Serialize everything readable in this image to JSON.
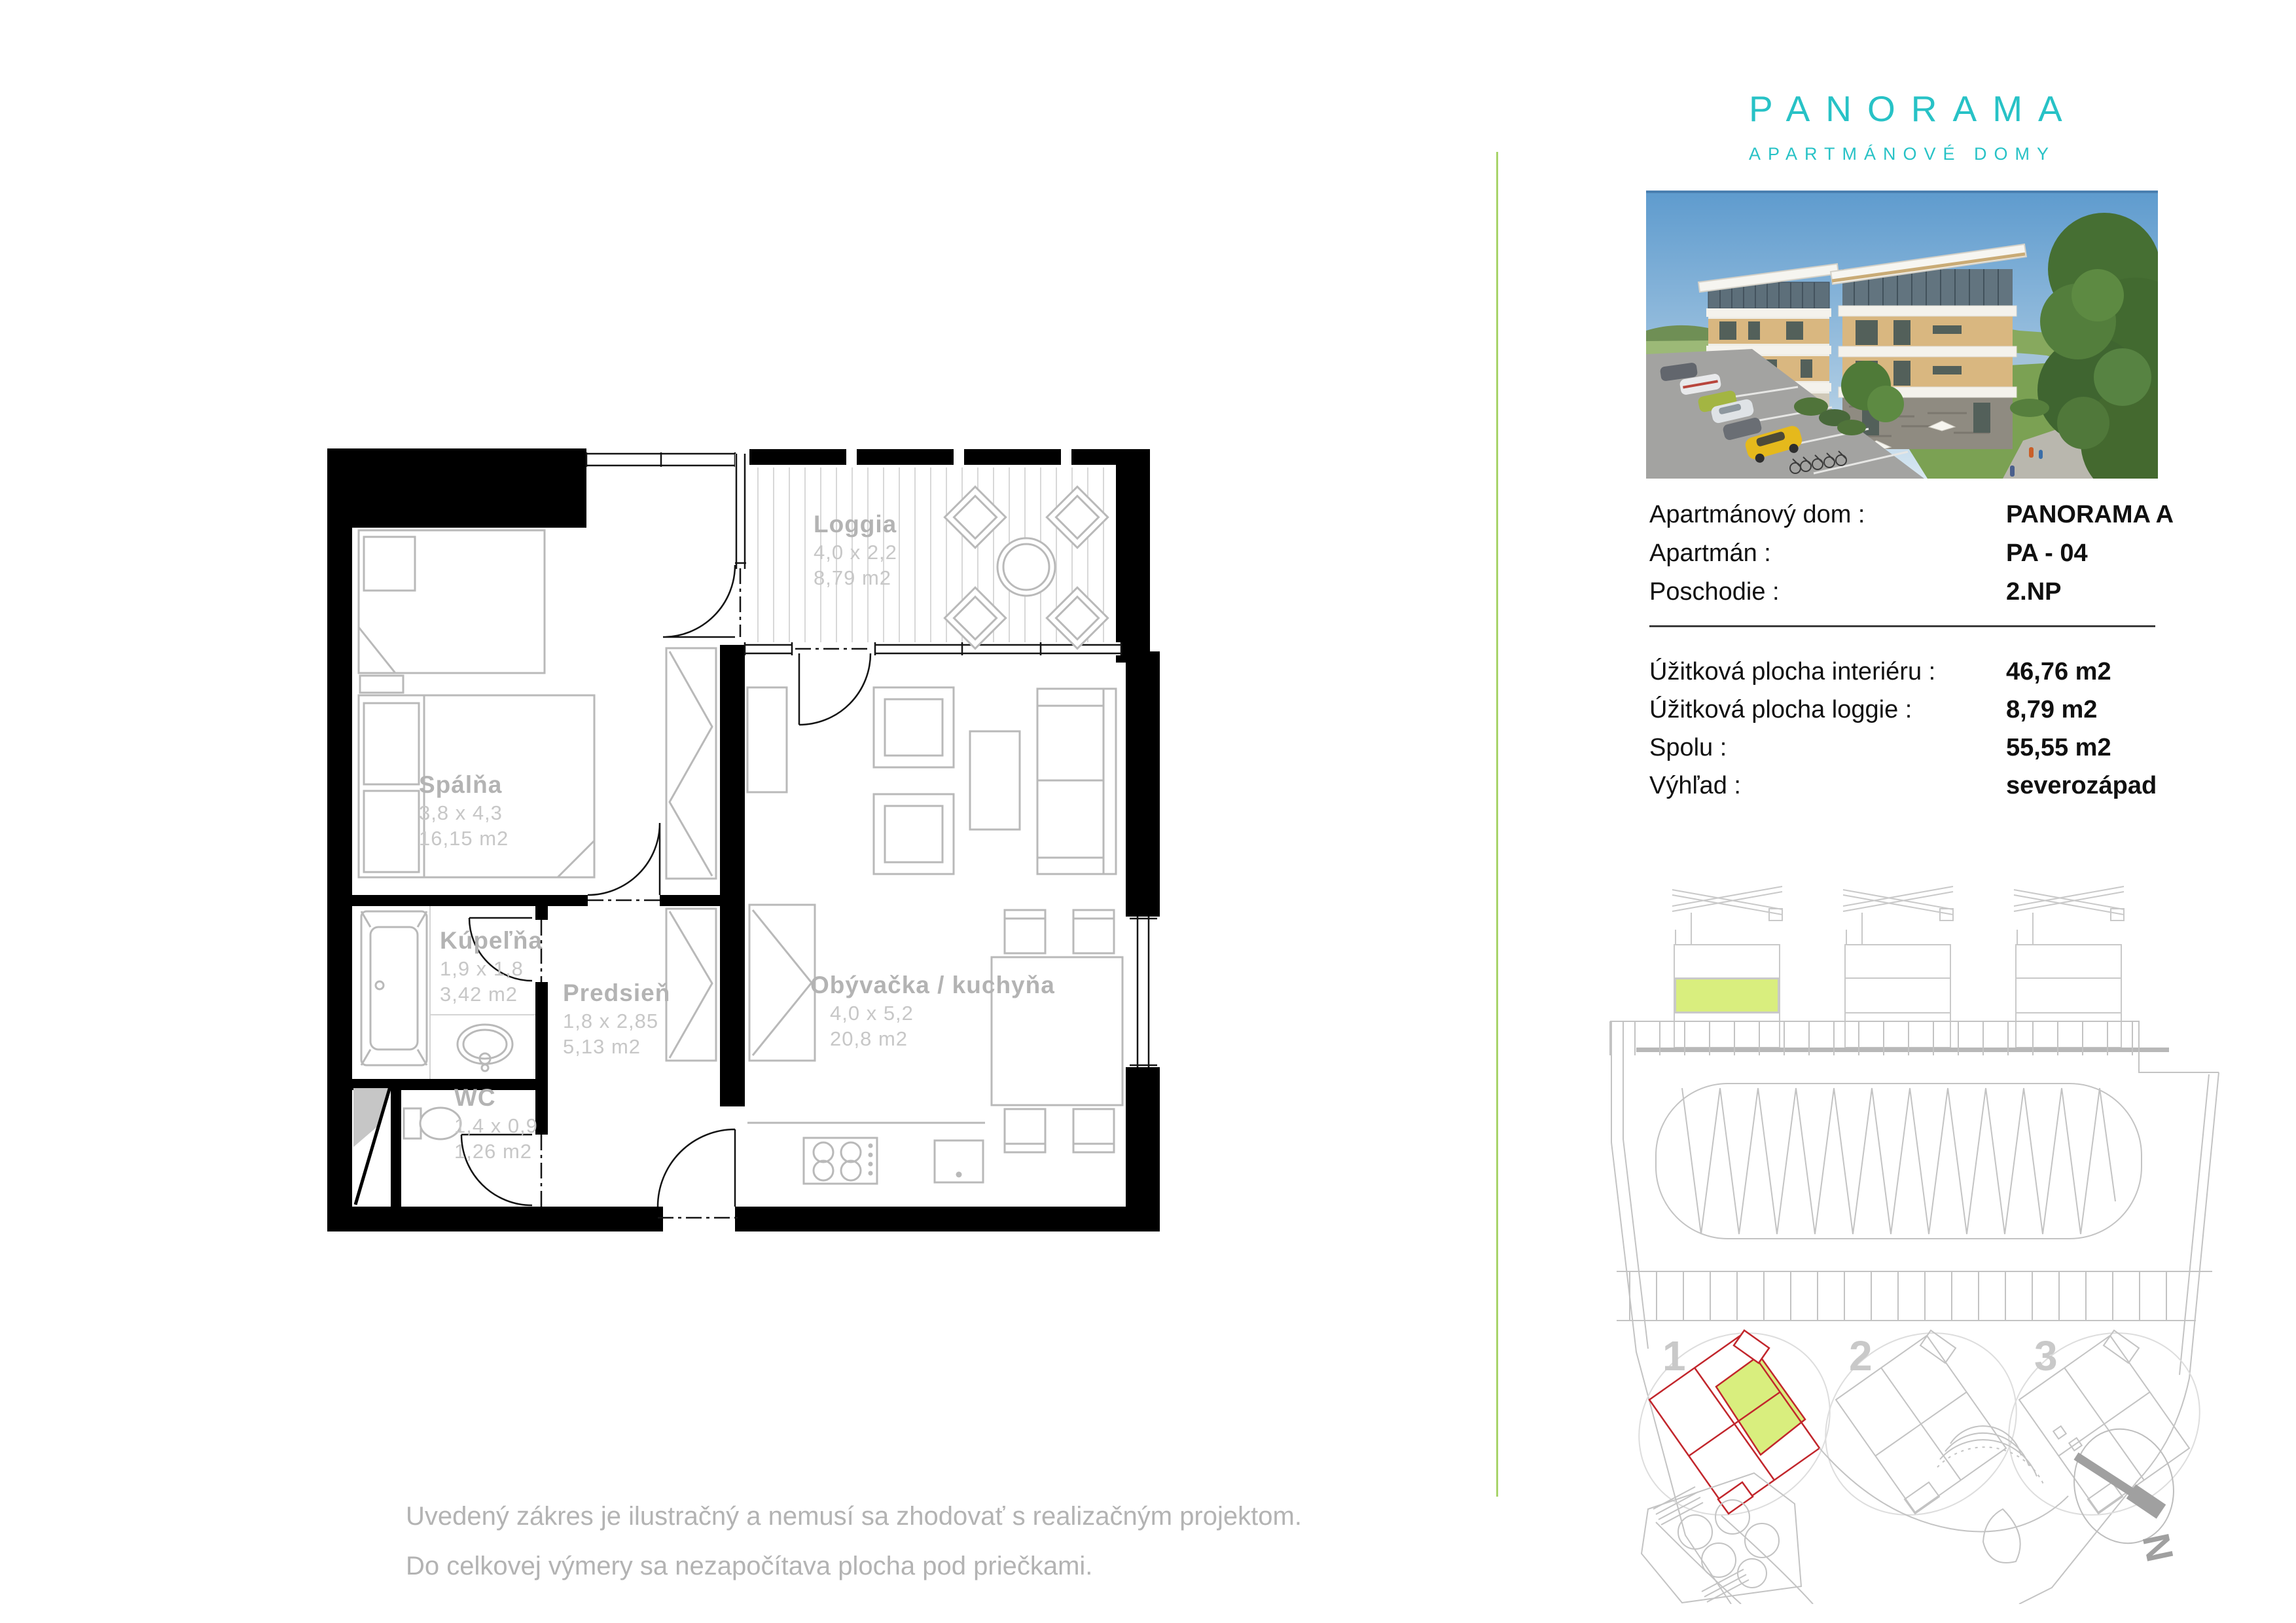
{
  "logo": {
    "title": "PANORAMA",
    "subtitle": "APARTMÁNOVÉ DOMY",
    "accent_color": "#27c2c6"
  },
  "info": {
    "rows": [
      {
        "label": "Apartmánový dom :",
        "value": "PANORAMA A"
      },
      {
        "label": "Apartmán :",
        "value": "PA - 04"
      },
      {
        "label": "Poschodie :",
        "value": "2.NP"
      }
    ],
    "area_rows": [
      {
        "label": "Úžitková plocha interiéru :",
        "value": "46,76 m2"
      },
      {
        "label": "Úžitková plocha loggie :",
        "value": "8,79 m2"
      },
      {
        "label": "Spolu :",
        "value": "55,55 m2"
      },
      {
        "label": "Výhľad :",
        "value": "severozápad"
      }
    ]
  },
  "floor_plan": {
    "rooms": [
      {
        "name": "Loggia",
        "dims": "4,0 x 2,2",
        "area": "8,79 m2"
      },
      {
        "name": "Spálňa",
        "dims": "3,8 x 4,3",
        "area": "16,15 m2"
      },
      {
        "name": "Kúpeľňa",
        "dims": "1,9 x 1,8",
        "area": "3,42 m2"
      },
      {
        "name": "Predsieň",
        "dims": "1,8 x 2,85",
        "area": "5,13 m2"
      },
      {
        "name": "WC",
        "dims": "1,4 x 0,9",
        "area": "1,26 m2"
      },
      {
        "name": "Obývačka / kuchyňa",
        "dims": "4,0 x 5,2",
        "area": "20,8 m2"
      }
    ]
  },
  "site_plan": {
    "building_numbers": [
      "1",
      "2",
      "3"
    ],
    "north_label": "N",
    "highlight_color": "#d9ee7e",
    "outline_color": "#c2262c"
  },
  "footer": {
    "line1": "Uvedený zákres je ilustračný a nemusí sa zhodovať s realizačným projektom.",
    "line2": "Do celkovej výmery sa nezapočítava plocha pod priečkami."
  }
}
